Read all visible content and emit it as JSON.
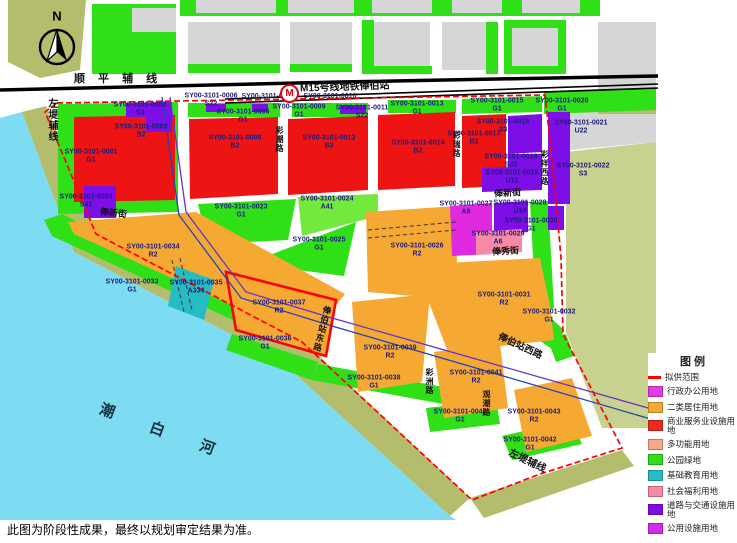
{
  "page": {
    "note": "此图为阶段性成果，最终以规划审定结果为准。"
  },
  "map": {
    "north": "N",
    "river": "潮 白 河",
    "metro": {
      "badge": "M",
      "label": "M15号线地铁俸伯站"
    },
    "roads": {
      "shunping": "顺 平 辅 线",
      "zuodi_left": "左堤辅线",
      "zuodi_bottom": "左堤辅线",
      "fengxin_w": "俸新街",
      "fengxin_e": "俸新街",
      "fengxiu": "俸秀街",
      "caichao": "彩潮路",
      "cairui": "彩瑞路",
      "caixiang_w": "彩祥西路",
      "caizhou": "彩洲路",
      "guanchao": "观潮路",
      "fengbo_e": "俸伯站东路",
      "fengbo_w": "俸伯站西路"
    },
    "parcels": [
      {
        "code": "SY00-3101-0001",
        "type": "G1"
      },
      {
        "code": "SY00-3101-0002",
        "type": "S3"
      },
      {
        "code": "SY00-3101-0003",
        "type": "B2"
      },
      {
        "code": "SY00-3101-0004",
        "type": "S41"
      },
      {
        "code": "SY00-3101-0005",
        "type": "G1"
      },
      {
        "code": "SY00-3101-0006",
        "type": "S22"
      },
      {
        "code": "SY00-3101-0007",
        "type": ""
      },
      {
        "code": "SY00-3101-0008",
        "type": "B2"
      },
      {
        "code": "SY00-3101-0009",
        "type": "G1"
      },
      {
        "code": "SY00-3101-0010",
        "type": ""
      },
      {
        "code": "SY00-3101-0011",
        "type": "S22"
      },
      {
        "code": "SY00-3101-0012",
        "type": "B2"
      },
      {
        "code": "SY00-3101-0013",
        "type": "G1"
      },
      {
        "code": "SY00-3101-0014",
        "type": "B2"
      },
      {
        "code": "SY00-3101-0015",
        "type": "G1"
      },
      {
        "code": "SY00-3101-0016",
        "type": "S3"
      },
      {
        "code": "SY00-3101-0017",
        "type": "B2"
      },
      {
        "code": "SY00-3101-0018",
        "type": "S42"
      },
      {
        "code": "SY00-3101-0019",
        "type": "U12"
      },
      {
        "code": "SY00-3101-0020",
        "type": "G1"
      },
      {
        "code": "SY00-3101-0021",
        "type": "U22"
      },
      {
        "code": "SY00-3101-0022",
        "type": "S3"
      },
      {
        "code": "SY00-3101-0023",
        "type": "G1"
      },
      {
        "code": "SY00-3101-0024",
        "type": "A41"
      },
      {
        "code": "SY00-3101-0025",
        "type": "G1"
      },
      {
        "code": "SY00-3101-0026",
        "type": "R2"
      },
      {
        "code": "SY00-3101-0027",
        "type": "A8"
      },
      {
        "code": "SY00-3101-0028",
        "type": "U14"
      },
      {
        "code": "SY00-3101-0029",
        "type": "A6"
      },
      {
        "code": "SY00-3101-0030",
        "type": "G1"
      },
      {
        "code": "SY00-3101-0031",
        "type": "R2"
      },
      {
        "code": "SY00-3101-0032",
        "type": "G1"
      },
      {
        "code": "SY00-3101-0033",
        "type": "G1"
      },
      {
        "code": "SY00-3101-0034",
        "type": "R2"
      },
      {
        "code": "SY00-3101-0035",
        "type": "A334"
      },
      {
        "code": "SY00-3101-0036",
        "type": "G1"
      },
      {
        "code": "SY00-3101-0037",
        "type": "R2"
      },
      {
        "code": "SY00-3101-0038",
        "type": "G1"
      },
      {
        "code": "SY00-3101-0039",
        "type": "R2"
      },
      {
        "code": "SY00-3101-0040",
        "type": "G1"
      },
      {
        "code": "SY00-3101-0041",
        "type": "R2"
      },
      {
        "code": "SY00-3101-0042",
        "type": "G1"
      },
      {
        "code": "SY00-3101-0043",
        "type": "R2"
      }
    ]
  },
  "legend": {
    "title": "图  例",
    "items": [
      {
        "label": "拟供范围",
        "color": "#ff0000"
      },
      {
        "label": "行政办公用地",
        "color": "#e73ae7"
      },
      {
        "label": "二类居住用地",
        "color": "#f5a933"
      },
      {
        "label": "商业服务业设施用地",
        "color": "#ee2a1e"
      },
      {
        "label": "多功能用地",
        "color": "#f7a687"
      },
      {
        "label": "公园绿地",
        "color": "#2fe017"
      },
      {
        "label": "基础教育用地",
        "color": "#25bcc4"
      },
      {
        "label": "社会福利用地",
        "color": "#f78ba6"
      },
      {
        "label": "道路与交通设施用地",
        "color": "#7e0ee8"
      },
      {
        "label": "公用设施用地",
        "color": "#d42af0"
      }
    ]
  }
}
